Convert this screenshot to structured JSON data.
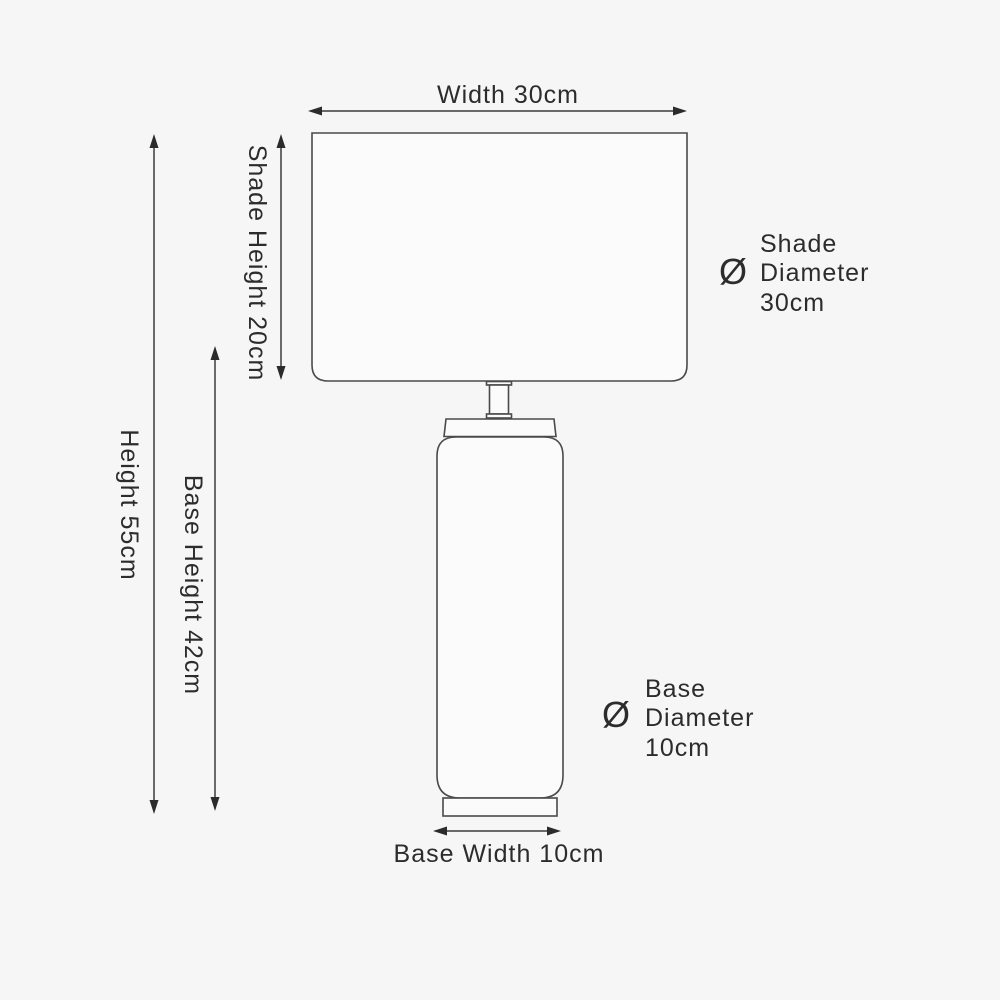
{
  "diagram": {
    "subject": "table-lamp-dimension-diagram",
    "labels": {
      "width": "Width 30cm",
      "shade_height": "Shade Height 20cm",
      "height": "Height 55cm",
      "base_height": "Base Height 42cm",
      "base_width": "Base Width 10cm"
    },
    "shade_diameter": {
      "symbol": "Ø",
      "lines": [
        "Shade",
        "Diameter",
        "30cm"
      ]
    },
    "base_diameter": {
      "symbol": "Ø",
      "lines": [
        "Base",
        "Diameter",
        "10cm"
      ]
    },
    "measurements_cm": {
      "width": 30,
      "shade_height": 20,
      "height": 55,
      "base_height": 42,
      "base_width": 10,
      "shade_diameter": 30,
      "base_diameter": 10
    },
    "colors": {
      "background": "#f6f6f6",
      "shape_fill": "#fbfbfb",
      "line": "#4a4a4a",
      "arrow": "#3c3c3c",
      "text": "#2c2c2c"
    }
  }
}
